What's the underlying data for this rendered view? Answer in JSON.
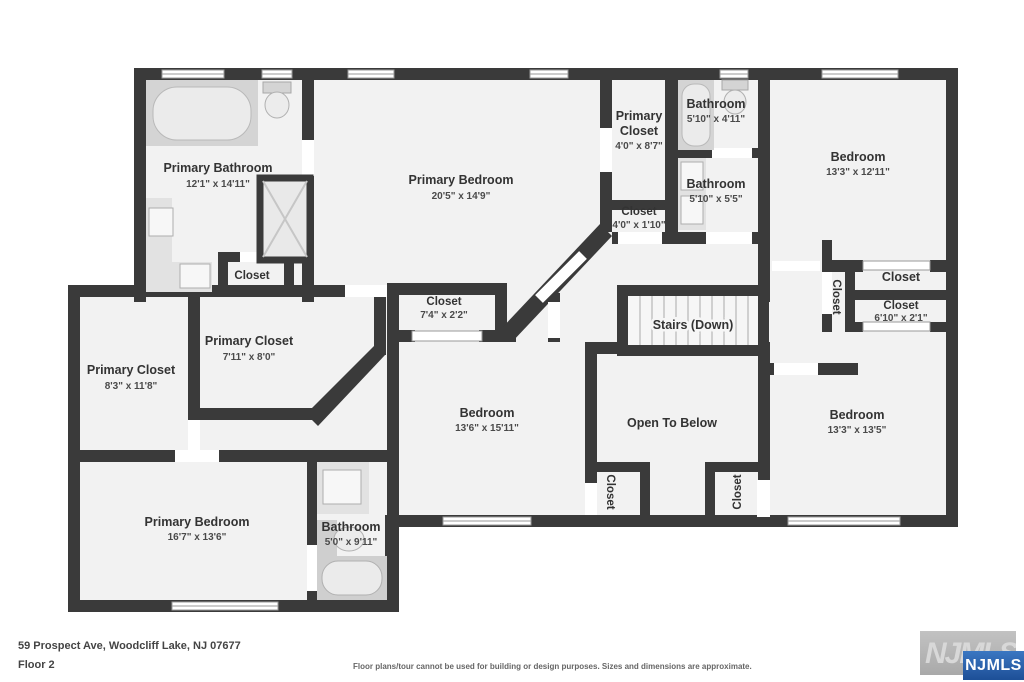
{
  "fp": {
    "address": "59 Prospect Ave, Woodcliff Lake, NJ 07677",
    "floor_label": "Floor 2",
    "disclaimer": "Floor plans/tour cannot be used for building or design purposes. Sizes and dimensions are approximate.",
    "logo": {
      "watermark_text": "NJMLS",
      "badge_text": "NJMLS",
      "badge_color": "#2a63ae",
      "watermark_bg": "#b5b5b5"
    },
    "colors": {
      "wall": "#3a3a3a",
      "floor": "#f2f2f2",
      "window_outline": "#9a9a9a",
      "fixture": "#d4d4d4"
    },
    "rooms": {
      "primary_bathroom": {
        "name": "Primary Bathroom",
        "dims": "12'1\" x 14'11\""
      },
      "bathroom_closet": {
        "name": "Closet"
      },
      "primary_bedroom_top": {
        "name": "Primary Bedroom",
        "dims": "20'5\" x 14'9\""
      },
      "primary_closet_hall": {
        "name1": "Primary",
        "name2": "Closet",
        "dims": "4'0\" x 8'7\""
      },
      "closet_hall": {
        "name": "Closet",
        "dims": "4'0\" x 1'10\""
      },
      "bathroom_top": {
        "name": "Bathroom",
        "dims": "5'10\" x 4'11\""
      },
      "bathroom_mid": {
        "name": "Bathroom",
        "dims": "5'10\" x 5'5\""
      },
      "bedroom_top_right": {
        "name": "Bedroom",
        "dims": "13'3\" x 12'11\""
      },
      "closet_vertical_right": {
        "name": "Closet"
      },
      "closet_top_right": {
        "name": "Closet"
      },
      "closet_610": {
        "name": "Closet",
        "dims": "6'10\" x 2'1\""
      },
      "primary_closet_left": {
        "name": "Primary Closet",
        "dims": "8'3\" x 11'8\""
      },
      "primary_closet_mid": {
        "name": "Primary Closet",
        "dims": "7'11\" x 8'0\""
      },
      "closet_mid": {
        "name": "Closet",
        "dims": "7'4\" x 2'2\""
      },
      "bedroom_middle": {
        "name": "Bedroom",
        "dims": "13'6\" x 15'11\""
      },
      "stairs": {
        "name": "Stairs (Down)"
      },
      "open_to_below": {
        "name": "Open To Below"
      },
      "closet_otb_left": {
        "name": "Closet"
      },
      "closet_otb_right": {
        "name": "Closet"
      },
      "primary_bedroom_bottom": {
        "name": "Primary Bedroom",
        "dims": "16'7\" x 13'6\""
      },
      "bathroom_bottom": {
        "name": "Bathroom",
        "dims": "5'0\" x 9'11\""
      },
      "bedroom_bottom_right": {
        "name": "Bedroom",
        "dims": "13'3\" x 13'5\""
      }
    }
  }
}
